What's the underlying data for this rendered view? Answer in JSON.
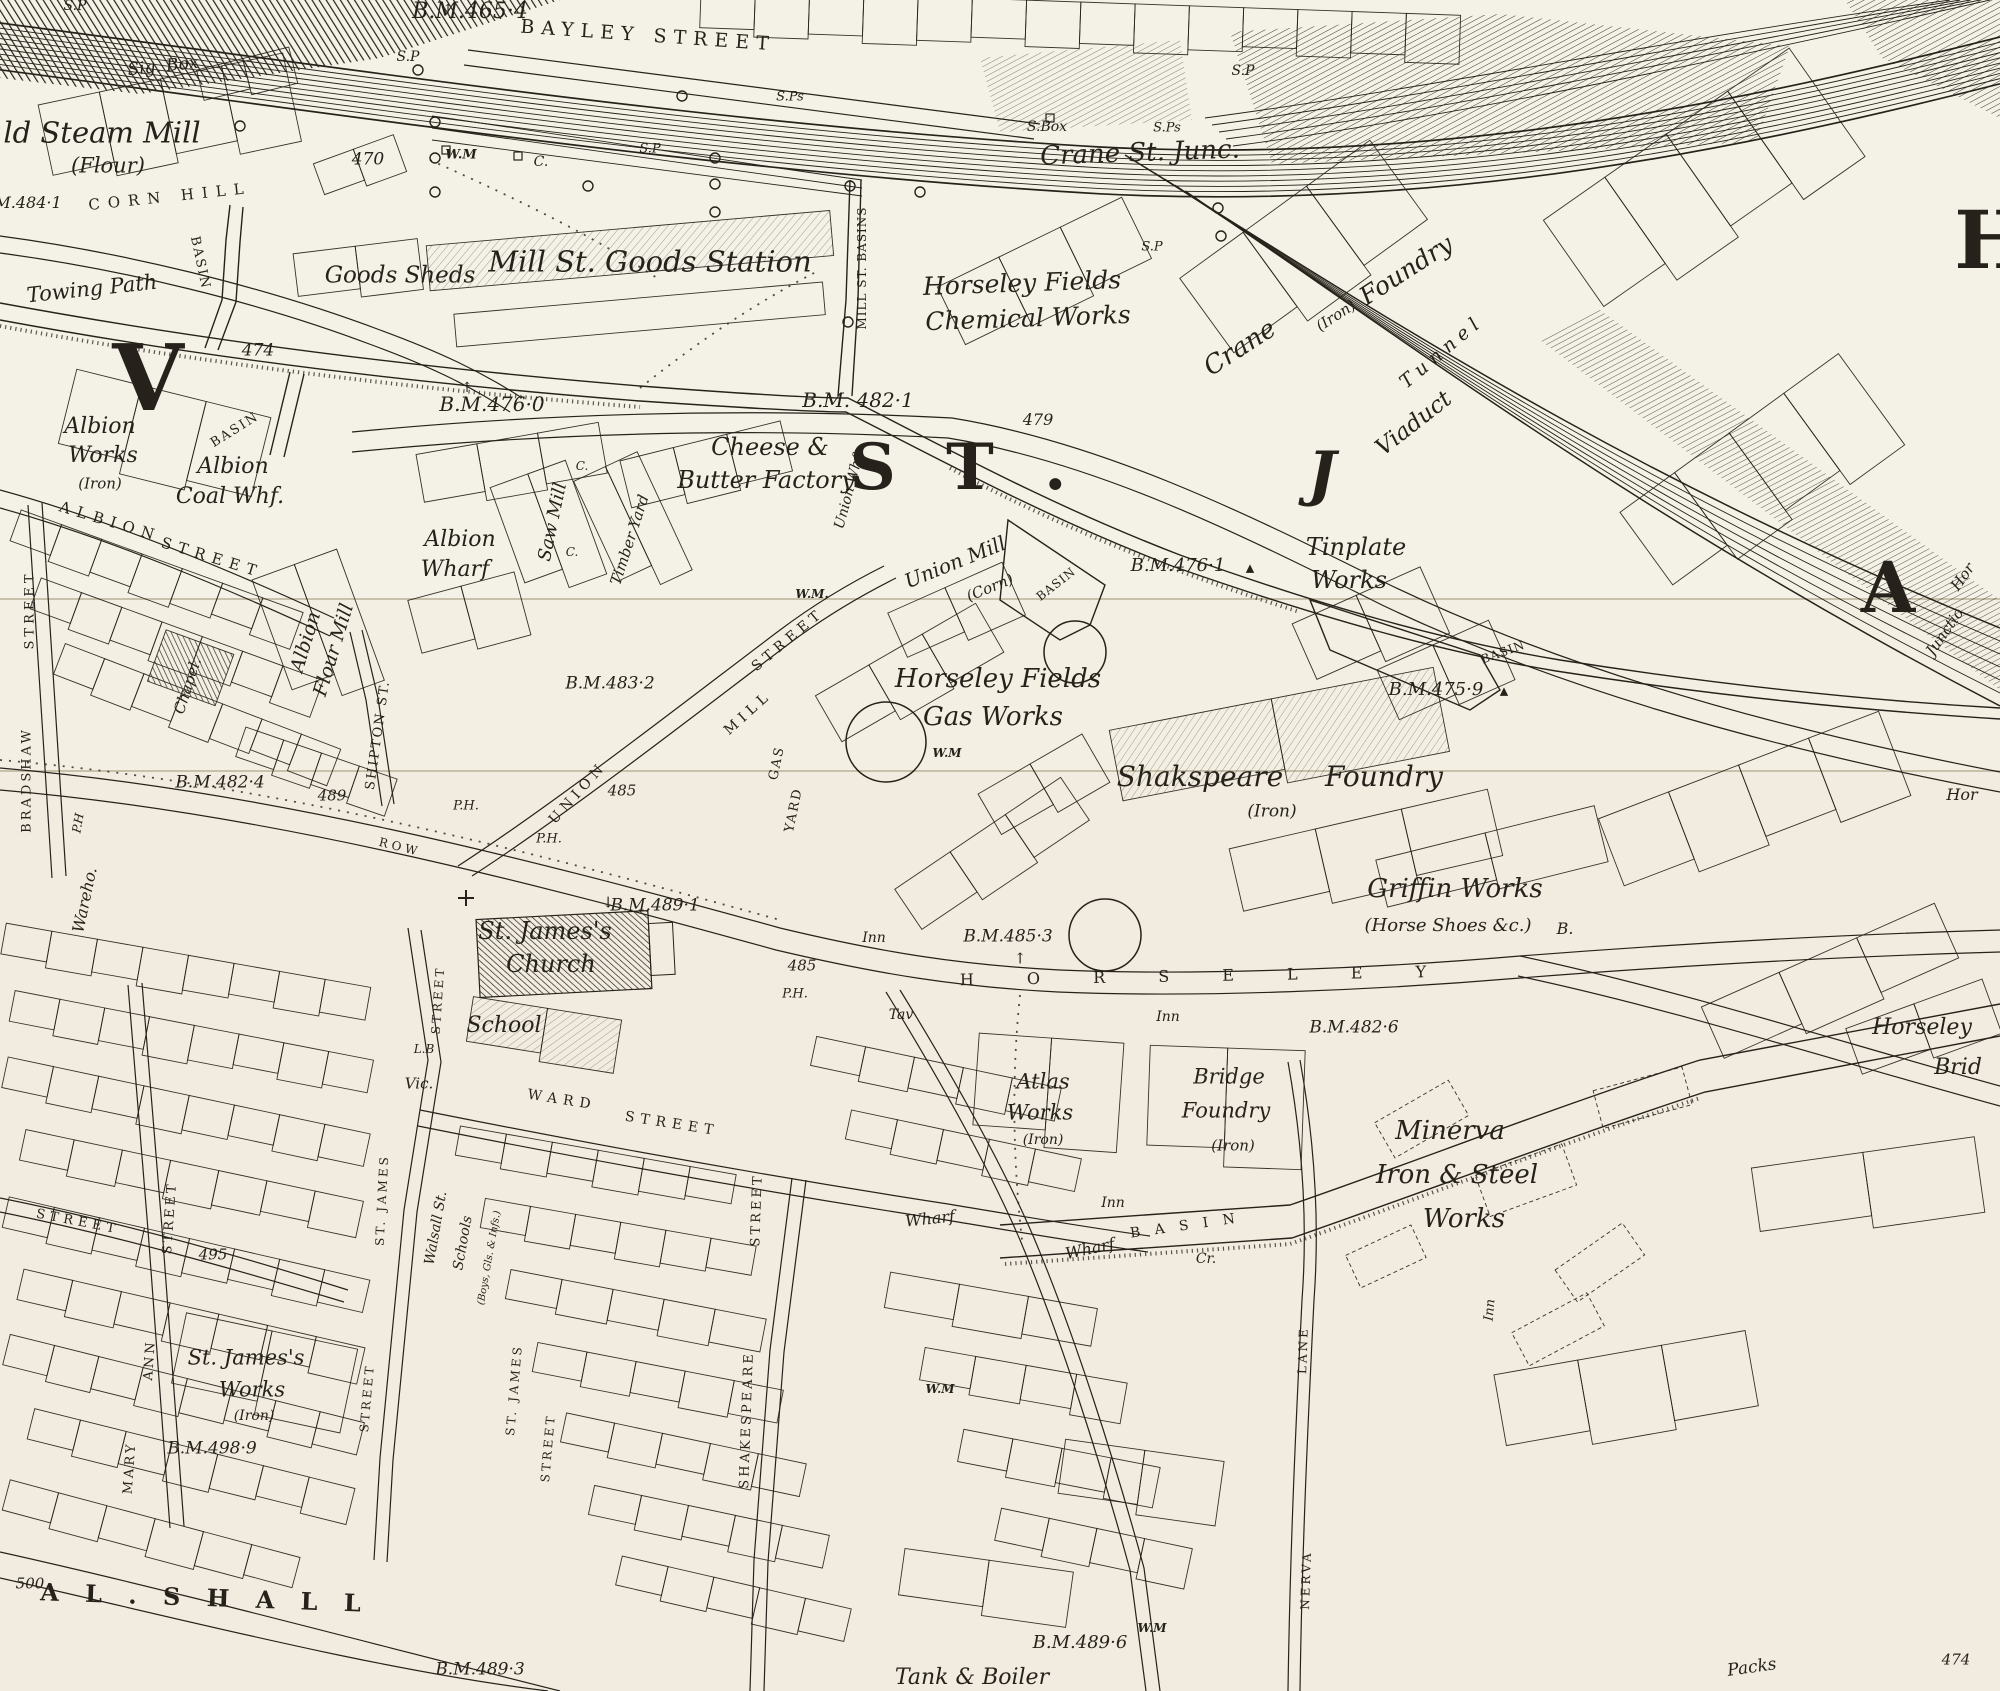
{
  "palette": {
    "paper": "#f3efe2",
    "paper_band_top": "#f4f1e6",
    "paper_band_low": "#f1ecdf",
    "ink": "#26221b",
    "seam": "#c7c0ab"
  },
  "labels": [
    {
      "t": "S.P",
      "x": 75,
      "y": 6,
      "s": 14,
      "i": 1
    },
    {
      "t": "B.M.465·4",
      "x": 470,
      "y": 12,
      "s": 22,
      "i": 1
    },
    {
      "t": "↑",
      "x": 448,
      "y": 10,
      "s": 14
    },
    {
      "t": "BAYLEY STREET",
      "x": 648,
      "y": 36,
      "s": 19,
      "ls": 7,
      "r": 4
    },
    {
      "t": "S.P",
      "x": 408,
      "y": 57,
      "s": 14,
      "i": 1
    },
    {
      "t": "Sig. Box",
      "x": 163,
      "y": 67,
      "s": 17,
      "i": 1,
      "r": -6
    },
    {
      "t": "S.Ps",
      "x": 790,
      "y": 97,
      "s": 13,
      "i": 1
    },
    {
      "t": "S.P",
      "x": 1243,
      "y": 71,
      "s": 14,
      "i": 1
    },
    {
      "t": "ld Steam Mill",
      "x": 102,
      "y": 133,
      "s": 29,
      "i": 1
    },
    {
      "t": "(Flour)",
      "x": 108,
      "y": 166,
      "s": 21,
      "i": 1
    },
    {
      "t": "S.Box",
      "x": 1047,
      "y": 127,
      "s": 14,
      "i": 1
    },
    {
      "t": "S.Ps",
      "x": 1167,
      "y": 128,
      "s": 13,
      "i": 1
    },
    {
      "t": "Crane St. Junc.",
      "x": 1140,
      "y": 153,
      "s": 26,
      "i": 1,
      "r": -2
    },
    {
      "t": "470",
      "x": 368,
      "y": 160,
      "s": 17,
      "i": 1
    },
    {
      "t": "W.M",
      "x": 461,
      "y": 155,
      "s": 13,
      "i": 1,
      "b": 1
    },
    {
      "t": "C.",
      "x": 541,
      "y": 162,
      "s": 14,
      "i": 1
    },
    {
      "t": "S.P",
      "x": 650,
      "y": 149,
      "s": 13,
      "i": 1
    },
    {
      "t": "M.484·1",
      "x": 28,
      "y": 203,
      "s": 16,
      "i": 1
    },
    {
      "t": "CORN HILL",
      "x": 170,
      "y": 197,
      "s": 15,
      "ls": 8,
      "r": -6
    },
    {
      "t": "S.P",
      "x": 1152,
      "y": 247,
      "s": 13,
      "i": 1
    },
    {
      "t": "Goods Sheds",
      "x": 400,
      "y": 276,
      "s": 23,
      "i": 1
    },
    {
      "t": "Mill St. Goods Station",
      "x": 650,
      "y": 262,
      "s": 29,
      "i": 1
    },
    {
      "t": "Horseley Fields",
      "x": 1022,
      "y": 283,
      "s": 25,
      "i": 1,
      "r": -2
    },
    {
      "t": "Chemical Works",
      "x": 1028,
      "y": 318,
      "s": 25,
      "i": 1,
      "r": -2
    },
    {
      "t": "Crane",
      "x": 1240,
      "y": 348,
      "s": 26,
      "i": 1,
      "r": -33
    },
    {
      "t": "(Iron)",
      "x": 1336,
      "y": 316,
      "s": 15,
      "i": 1,
      "r": -33
    },
    {
      "t": "Foundry",
      "x": 1406,
      "y": 270,
      "s": 25,
      "i": 1,
      "r": -33
    },
    {
      "t": "Tunnel",
      "x": 1442,
      "y": 352,
      "s": 19,
      "i": 1,
      "ls": 6,
      "r": -40
    },
    {
      "t": "Viaduct",
      "x": 1414,
      "y": 424,
      "s": 23,
      "i": 1,
      "r": -38
    },
    {
      "t": "Towing Path",
      "x": 92,
      "y": 289,
      "s": 21,
      "i": 1,
      "r": -6
    },
    {
      "t": "BASIN",
      "x": 200,
      "y": 263,
      "s": 13,
      "ls": 2,
      "r": 78
    },
    {
      "t": "474",
      "x": 258,
      "y": 351,
      "s": 17,
      "i": 1
    },
    {
      "t": "↑",
      "x": 467,
      "y": 388,
      "s": 14
    },
    {
      "t": "B.M.476·0",
      "x": 492,
      "y": 404,
      "s": 20,
      "i": 1
    },
    {
      "t": "B.M. 482·1",
      "x": 858,
      "y": 400,
      "s": 20,
      "i": 1
    },
    {
      "t": "479",
      "x": 1038,
      "y": 420,
      "s": 16,
      "i": 1
    },
    {
      "t": "MILL ST. BASINS",
      "x": 862,
      "y": 268,
      "s": 12,
      "ls": 1,
      "r": -90
    },
    {
      "t": "V",
      "x": 148,
      "y": 378,
      "s": 92,
      "b": 1
    },
    {
      "t": "S T .",
      "x": 965,
      "y": 468,
      "s": 64,
      "b": 1,
      "ls": 14
    },
    {
      "t": "J",
      "x": 1322,
      "y": 474,
      "s": 60,
      "b": 1,
      "i": 1
    },
    {
      "t": "A",
      "x": 1888,
      "y": 588,
      "s": 70,
      "b": 1
    },
    {
      "t": "H",
      "x": 1992,
      "y": 240,
      "s": 80,
      "b": 1
    },
    {
      "t": "Albion",
      "x": 100,
      "y": 427,
      "s": 22,
      "i": 1
    },
    {
      "t": "Works",
      "x": 103,
      "y": 456,
      "s": 22,
      "i": 1
    },
    {
      "t": "(Iron)",
      "x": 100,
      "y": 484,
      "s": 15,
      "i": 1
    },
    {
      "t": "BASIN",
      "x": 235,
      "y": 430,
      "s": 13,
      "ls": 2,
      "r": -32
    },
    {
      "t": "Albion",
      "x": 233,
      "y": 467,
      "s": 22,
      "i": 1
    },
    {
      "t": "Coal Whf.",
      "x": 230,
      "y": 497,
      "s": 22,
      "i": 1
    },
    {
      "t": "ALBION",
      "x": 110,
      "y": 522,
      "s": 15,
      "ls": 7,
      "r": 17
    },
    {
      "t": "STREET",
      "x": 212,
      "y": 558,
      "s": 15,
      "ls": 7,
      "r": 17
    },
    {
      "t": "STREET",
      "x": 30,
      "y": 610,
      "s": 13,
      "ls": 4,
      "r": -90
    },
    {
      "t": "BRADSHAW",
      "x": 27,
      "y": 780,
      "s": 13,
      "ls": 3,
      "r": -90
    },
    {
      "t": "Albion",
      "x": 306,
      "y": 642,
      "s": 19,
      "i": 1,
      "r": -73
    },
    {
      "t": "Flour Mill",
      "x": 334,
      "y": 650,
      "s": 19,
      "i": 1,
      "r": -73
    },
    {
      "t": "Albion",
      "x": 460,
      "y": 540,
      "s": 22,
      "i": 1
    },
    {
      "t": "Wharf",
      "x": 455,
      "y": 570,
      "s": 22,
      "i": 1
    },
    {
      "t": "Saw Mill",
      "x": 553,
      "y": 522,
      "s": 18,
      "i": 1,
      "r": -78
    },
    {
      "t": "C.",
      "x": 582,
      "y": 466,
      "s": 12,
      "i": 1
    },
    {
      "t": "Timber Yard",
      "x": 630,
      "y": 540,
      "s": 15,
      "i": 1,
      "r": -72
    },
    {
      "t": "C.",
      "x": 572,
      "y": 552,
      "s": 12,
      "i": 1
    },
    {
      "t": "Cheese &",
      "x": 770,
      "y": 447,
      "s": 24,
      "i": 1
    },
    {
      "t": "Butter Factory",
      "x": 766,
      "y": 480,
      "s": 24,
      "i": 1
    },
    {
      "t": "Union Whf",
      "x": 849,
      "y": 492,
      "s": 14,
      "i": 1,
      "r": -75
    },
    {
      "t": "W.M.",
      "x": 812,
      "y": 594,
      "s": 12,
      "i": 1,
      "b": 1
    },
    {
      "t": "Union Mill",
      "x": 955,
      "y": 562,
      "s": 20,
      "i": 1,
      "r": -22
    },
    {
      "t": "(Corn)",
      "x": 990,
      "y": 588,
      "s": 15,
      "i": 1,
      "r": -22
    },
    {
      "t": "BASIN",
      "x": 1056,
      "y": 584,
      "s": 12,
      "ls": 1,
      "r": -38
    },
    {
      "t": "B.M.476·1",
      "x": 1178,
      "y": 566,
      "s": 18,
      "i": 1
    },
    {
      "t": "▲",
      "x": 1250,
      "y": 568,
      "s": 11
    },
    {
      "t": "BASIN",
      "x": 1503,
      "y": 652,
      "s": 12,
      "ls": 1,
      "r": -20
    },
    {
      "t": "Tinplate",
      "x": 1356,
      "y": 547,
      "s": 24,
      "i": 1
    },
    {
      "t": "Works",
      "x": 1349,
      "y": 580,
      "s": 24,
      "i": 1
    },
    {
      "t": "Hor",
      "x": 1963,
      "y": 577,
      "s": 15,
      "i": 1,
      "r": -55
    },
    {
      "t": "Junctio",
      "x": 1945,
      "y": 632,
      "s": 15,
      "i": 1,
      "r": -55
    },
    {
      "t": "B.M.475·9",
      "x": 1436,
      "y": 690,
      "s": 18,
      "i": 1
    },
    {
      "t": "▲",
      "x": 1504,
      "y": 691,
      "s": 11
    },
    {
      "t": "B.M.483·2",
      "x": 610,
      "y": 684,
      "s": 17,
      "i": 1
    },
    {
      "t": "Horseley Fields",
      "x": 998,
      "y": 679,
      "s": 26,
      "i": 1
    },
    {
      "t": "Gas Works",
      "x": 993,
      "y": 717,
      "s": 26,
      "i": 1
    },
    {
      "t": "W.M",
      "x": 947,
      "y": 753,
      "s": 12,
      "i": 1,
      "b": 1
    },
    {
      "t": "Shakspeare",
      "x": 1200,
      "y": 777,
      "s": 28,
      "i": 1
    },
    {
      "t": "Foundry",
      "x": 1384,
      "y": 777,
      "s": 28,
      "i": 1
    },
    {
      "t": "(Iron)",
      "x": 1272,
      "y": 812,
      "s": 17,
      "i": 1
    },
    {
      "t": "Chapel.",
      "x": 188,
      "y": 686,
      "s": 15,
      "i": 1,
      "r": -72
    },
    {
      "t": "ROW",
      "x": 400,
      "y": 847,
      "s": 12,
      "ls": 4,
      "r": 14
    },
    {
      "t": "SHIPTON ST.",
      "x": 378,
      "y": 735,
      "s": 13,
      "ls": 2,
      "r": -82
    },
    {
      "t": "P.H",
      "x": 78,
      "y": 823,
      "s": 12,
      "i": 1,
      "r": -80
    },
    {
      "t": "B.M.482·4",
      "x": 220,
      "y": 783,
      "s": 17,
      "i": 1
    },
    {
      "t": "489",
      "x": 332,
      "y": 796,
      "s": 15,
      "i": 1
    },
    {
      "t": "Wareho.",
      "x": 85,
      "y": 900,
      "s": 16,
      "i": 1,
      "r": -78
    },
    {
      "t": "UNION",
      "x": 578,
      "y": 793,
      "s": 14,
      "ls": 5,
      "r": -48
    },
    {
      "t": "MILL",
      "x": 748,
      "y": 713,
      "s": 14,
      "ls": 5,
      "r": -42
    },
    {
      "t": "STREET",
      "x": 788,
      "y": 640,
      "s": 14,
      "ls": 5,
      "r": -40
    },
    {
      "t": "485",
      "x": 622,
      "y": 791,
      "s": 15,
      "i": 1
    },
    {
      "t": "P.H.",
      "x": 466,
      "y": 806,
      "s": 13,
      "i": 1
    },
    {
      "t": "P.H.",
      "x": 549,
      "y": 839,
      "s": 13,
      "i": 1
    },
    {
      "t": "GAS",
      "x": 777,
      "y": 763,
      "s": 13,
      "ls": 2,
      "r": -78
    },
    {
      "t": "YARD",
      "x": 794,
      "y": 810,
      "s": 13,
      "ls": 2,
      "r": -78
    },
    {
      "t": "L.B",
      "x": 424,
      "y": 1049,
      "s": 12,
      "i": 1
    },
    {
      "t": "Vic.",
      "x": 419,
      "y": 1084,
      "s": 15,
      "i": 1
    },
    {
      "t": "St. James's",
      "x": 545,
      "y": 931,
      "s": 24,
      "i": 1
    },
    {
      "t": "Church",
      "x": 551,
      "y": 964,
      "s": 24,
      "i": 1
    },
    {
      "t": "↓",
      "x": 608,
      "y": 903,
      "s": 15
    },
    {
      "t": "B.M.489·1",
      "x": 655,
      "y": 906,
      "s": 17,
      "i": 1
    },
    {
      "t": "School",
      "x": 504,
      "y": 1026,
      "s": 22,
      "i": 1
    },
    {
      "t": "WARD",
      "x": 562,
      "y": 1100,
      "s": 14,
      "ls": 6,
      "r": 9
    },
    {
      "t": "STREET",
      "x": 672,
      "y": 1124,
      "s": 14,
      "ls": 6,
      "r": 9
    },
    {
      "t": "STREET",
      "x": 438,
      "y": 1000,
      "s": 12,
      "ls": 3,
      "r": -86
    },
    {
      "t": "ST. JAMES",
      "x": 382,
      "y": 1200,
      "s": 12,
      "ls": 3,
      "r": -87
    },
    {
      "t": "STREET",
      "x": 367,
      "y": 1398,
      "s": 12,
      "ls": 3,
      "r": -85
    },
    {
      "t": "ST. JAMES",
      "x": 514,
      "y": 1390,
      "s": 12,
      "ls": 3,
      "r": -85
    },
    {
      "t": "STREET",
      "x": 548,
      "y": 1448,
      "s": 12,
      "ls": 3,
      "r": -85
    },
    {
      "t": "Walsall St.",
      "x": 436,
      "y": 1228,
      "s": 14,
      "i": 1,
      "r": -80
    },
    {
      "t": "Schools",
      "x": 463,
      "y": 1243,
      "s": 14,
      "i": 1,
      "r": -80
    },
    {
      "t": "(Boys, Gls. & Infs.)",
      "x": 490,
      "y": 1258,
      "s": 10,
      "i": 1,
      "r": -80
    },
    {
      "t": "MARY",
      "x": 130,
      "y": 1468,
      "s": 13,
      "ls": 3,
      "r": -86
    },
    {
      "t": "ANN",
      "x": 150,
      "y": 1360,
      "s": 13,
      "ls": 3,
      "r": -86
    },
    {
      "t": "STREET",
      "x": 170,
      "y": 1218,
      "s": 13,
      "ls": 3,
      "r": -86
    },
    {
      "t": "STREET",
      "x": 78,
      "y": 1222,
      "s": 13,
      "ls": 5,
      "r": 11
    },
    {
      "t": "495",
      "x": 213,
      "y": 1255,
      "s": 15,
      "i": 1
    },
    {
      "t": "St. James's",
      "x": 246,
      "y": 1358,
      "s": 21,
      "i": 1
    },
    {
      "t": "Works",
      "x": 252,
      "y": 1390,
      "s": 21,
      "i": 1
    },
    {
      "t": "(Iron)",
      "x": 254,
      "y": 1416,
      "s": 14,
      "i": 1
    },
    {
      "t": "B.M.498·9",
      "x": 212,
      "y": 1449,
      "s": 17,
      "i": 1
    },
    {
      "t": "500",
      "x": 30,
      "y": 1584,
      "s": 15,
      "i": 1
    },
    {
      "t": "A L . S H A L L",
      "x": 205,
      "y": 1598,
      "s": 24,
      "b": 1,
      "ls": 9,
      "r": 2
    },
    {
      "t": "B.M.489·3",
      "x": 480,
      "y": 1670,
      "s": 17,
      "i": 1
    },
    {
      "t": "STREET",
      "x": 757,
      "y": 1210,
      "s": 13,
      "ls": 3,
      "r": -88
    },
    {
      "t": "SHAKESPEARE",
      "x": 747,
      "y": 1420,
      "s": 13,
      "ls": 3,
      "r": -88
    },
    {
      "t": "485",
      "x": 802,
      "y": 966,
      "s": 15,
      "i": 1
    },
    {
      "t": "P.H.",
      "x": 795,
      "y": 994,
      "s": 13,
      "i": 1
    },
    {
      "t": "↑",
      "x": 1020,
      "y": 959,
      "s": 15
    },
    {
      "t": "H O R S E L E Y",
      "x": 1205,
      "y": 976,
      "s": 16,
      "ls": 24,
      "r": -1
    },
    {
      "t": "B.M.485·3",
      "x": 1008,
      "y": 937,
      "s": 17,
      "i": 1
    },
    {
      "t": "Inn",
      "x": 874,
      "y": 938,
      "s": 14,
      "i": 1
    },
    {
      "t": "Tav",
      "x": 901,
      "y": 1015,
      "s": 14,
      "i": 1
    },
    {
      "t": "Inn",
      "x": 1168,
      "y": 1017,
      "s": 14,
      "i": 1
    },
    {
      "t": "Inn",
      "x": 1113,
      "y": 1203,
      "s": 14,
      "i": 1
    },
    {
      "t": "Inn",
      "x": 1490,
      "y": 1310,
      "s": 13,
      "i": 1,
      "r": -85
    },
    {
      "t": "B.M.482·6",
      "x": 1354,
      "y": 1028,
      "s": 17,
      "i": 1
    },
    {
      "t": "Horseley",
      "x": 1922,
      "y": 1028,
      "s": 22,
      "i": 1
    },
    {
      "t": "Brid",
      "x": 1958,
      "y": 1068,
      "s": 22,
      "i": 1
    },
    {
      "t": "Atlas",
      "x": 1043,
      "y": 1082,
      "s": 21,
      "i": 1
    },
    {
      "t": "Works",
      "x": 1040,
      "y": 1113,
      "s": 21,
      "i": 1
    },
    {
      "t": "(Iron)",
      "x": 1043,
      "y": 1140,
      "s": 14,
      "i": 1
    },
    {
      "t": "Bridge",
      "x": 1229,
      "y": 1077,
      "s": 21,
      "i": 1
    },
    {
      "t": "Foundry",
      "x": 1226,
      "y": 1111,
      "s": 21,
      "i": 1
    },
    {
      "t": "(Iron)",
      "x": 1233,
      "y": 1146,
      "s": 15,
      "i": 1
    },
    {
      "t": "Minerva",
      "x": 1450,
      "y": 1131,
      "s": 26,
      "i": 1
    },
    {
      "t": "Iron & Steel",
      "x": 1457,
      "y": 1175,
      "s": 26,
      "i": 1
    },
    {
      "t": "Works",
      "x": 1464,
      "y": 1219,
      "s": 26,
      "i": 1
    },
    {
      "t": "LANE",
      "x": 1303,
      "y": 1350,
      "s": 12,
      "ls": 3,
      "r": -88
    },
    {
      "t": "NERVA",
      "x": 1306,
      "y": 1580,
      "s": 12,
      "ls": 3,
      "r": -88
    },
    {
      "t": "B A S I N",
      "x": 1185,
      "y": 1226,
      "s": 14,
      "ls": 5,
      "r": -8
    },
    {
      "t": "Wharf",
      "x": 930,
      "y": 1219,
      "s": 16,
      "i": 1,
      "r": -6
    },
    {
      "t": "Wharf",
      "x": 1090,
      "y": 1249,
      "s": 16,
      "i": 1,
      "r": -12
    },
    {
      "t": "Cr.",
      "x": 1206,
      "y": 1259,
      "s": 14,
      "i": 1
    },
    {
      "t": "W.M",
      "x": 940,
      "y": 1389,
      "s": 12,
      "i": 1,
      "b": 1
    },
    {
      "t": "W.M",
      "x": 1152,
      "y": 1628,
      "s": 12,
      "i": 1,
      "b": 1
    },
    {
      "t": "B.M.489·6",
      "x": 1080,
      "y": 1643,
      "s": 18,
      "i": 1
    },
    {
      "t": "Tank & Boiler",
      "x": 972,
      "y": 1678,
      "s": 22,
      "i": 1
    },
    {
      "t": "Packs",
      "x": 1752,
      "y": 1668,
      "s": 17,
      "i": 1,
      "r": -8
    },
    {
      "t": "474",
      "x": 1956,
      "y": 1660,
      "s": 15,
      "i": 1
    },
    {
      "t": "Griffin Works",
      "x": 1455,
      "y": 889,
      "s": 26,
      "i": 1
    },
    {
      "t": "(Horse Shoes &c.)",
      "x": 1448,
      "y": 926,
      "s": 18,
      "i": 1
    },
    {
      "t": "B.",
      "x": 1565,
      "y": 929,
      "s": 16,
      "i": 1
    },
    {
      "t": "Hor",
      "x": 1962,
      "y": 795,
      "s": 16,
      "i": 1
    }
  ]
}
